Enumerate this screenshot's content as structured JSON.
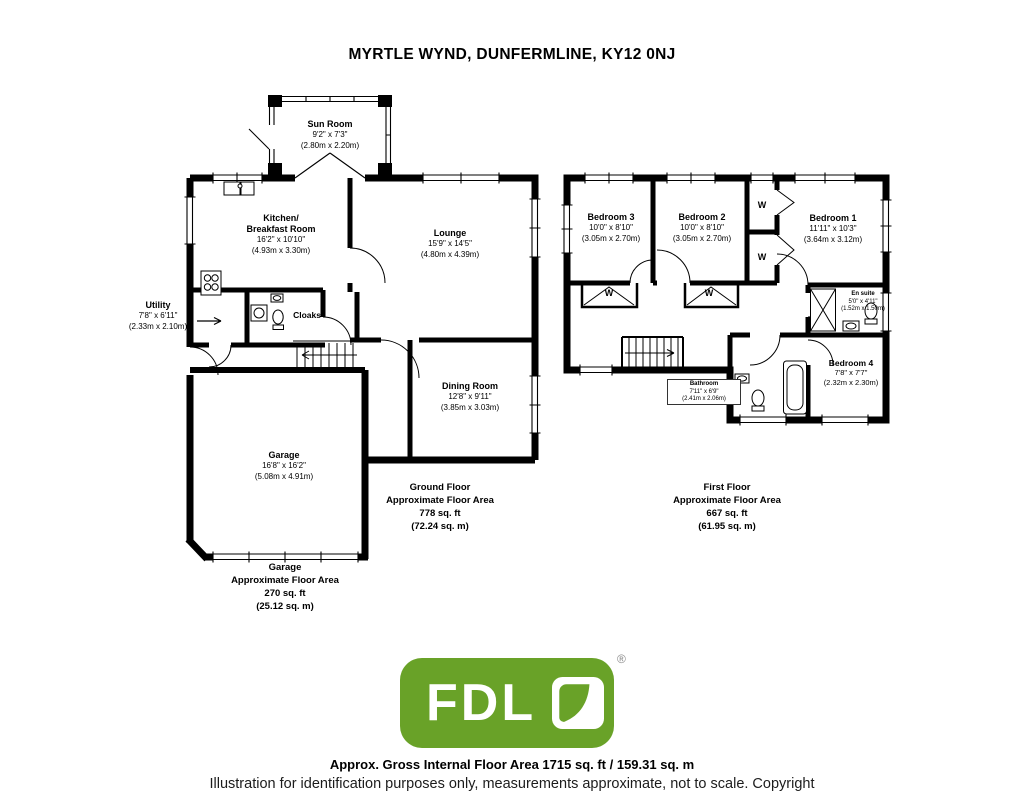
{
  "title": "MYRTLE WYND, DUNFERMLINE, KY12 0NJ",
  "ground": {
    "sun": {
      "name": "Sun Room",
      "ft": "9'2\" x 7'3\"",
      "m": "(2.80m x 2.20m)"
    },
    "kitchen": {
      "name1": "Kitchen/",
      "name2": "Breakfast Room",
      "ft": "16'2\" x 10'10\"",
      "m": "(4.93m x 3.30m)"
    },
    "lounge": {
      "name": "Lounge",
      "ft": "15'9\" x 14'5\"",
      "m": "(4.80m x 4.39m)"
    },
    "utility": {
      "name": "Utility",
      "ft": "7'8\" x 6'11\"",
      "m": "(2.33m x 2.10m)"
    },
    "cloaks": {
      "name": "Cloaks"
    },
    "dining": {
      "name": "Dining Room",
      "ft": "12'8\" x 9'11\"",
      "m": "(3.85m x 3.03m)"
    },
    "garage": {
      "name": "Garage",
      "ft": "16'8\" x 16'2\"",
      "m": "(5.08m x 4.91m)"
    },
    "area": {
      "l1": "Ground Floor",
      "l2": "Approximate Floor Area",
      "l3": "778 sq. ft",
      "l4": "(72.24 sq. m)"
    },
    "garage_area": {
      "l1": "Garage",
      "l2": "Approximate Floor Area",
      "l3": "270 sq. ft",
      "l4": "(25.12 sq. m)"
    }
  },
  "first": {
    "bed3": {
      "name": "Bedroom 3",
      "ft": "10'0\" x 8'10\"",
      "m": "(3.05m x 2.70m)"
    },
    "bed2": {
      "name": "Bedroom 2",
      "ft": "10'0\" x 8'10\"",
      "m": "(3.05m x 2.70m)"
    },
    "bed1": {
      "name": "Bedroom 1",
      "ft": "11'11\" x 10'3\"",
      "m": "(3.64m x 3.12m)"
    },
    "ensuite": {
      "name": "En suite",
      "ft": "5'0\" x 4'11\"",
      "m": "(1.52m x 1.50m)"
    },
    "bed4": {
      "name": "Bedroom 4",
      "ft": "7'8\" x 7'7\"",
      "m": "(2.32m x 2.30m)"
    },
    "bathroom": {
      "name": "Bathroom",
      "ft": "7'11\" x 6'9\"",
      "m": "(2.41m x 2.06m)"
    },
    "wardrobe": "W",
    "area": {
      "l1": "First Floor",
      "l2": "Approximate Floor Area",
      "l3": "667 sq. ft",
      "l4": "(61.95 sq. m)"
    }
  },
  "logo": {
    "text": "FDL",
    "registered": "®",
    "green": "#69a228"
  },
  "footer": {
    "line1": "Approx. Gross Internal Floor Area 1715 sq. ft / 159.31 sq. m",
    "line2": "Illustration for identification purposes only, measurements approximate, not to scale. Copyright"
  }
}
